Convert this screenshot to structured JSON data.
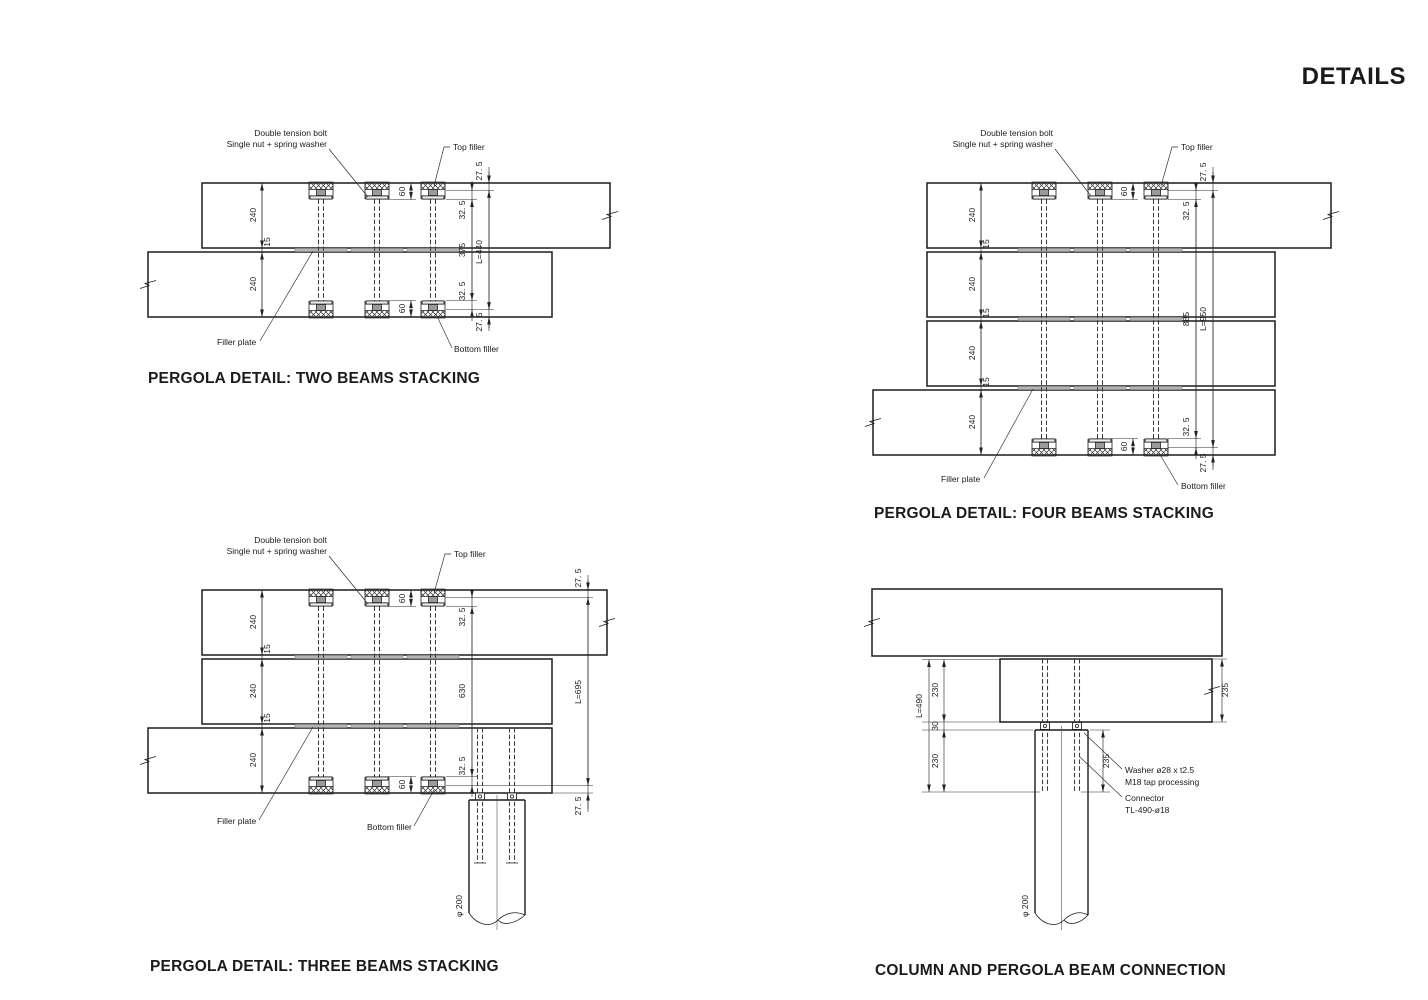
{
  "page_title": "DETAILS",
  "panels": {
    "two": {
      "title": "PERGOLA DETAIL: TWO BEAMS STACKING",
      "labels": {
        "tension_bolt_1": "Double tension bolt",
        "tension_bolt_2": "Single  nut + spring washer",
        "top_filler": "Top filler",
        "filler_plate": "Filler plate",
        "bottom_filler": "Bottom filler"
      },
      "dims": {
        "beams": [
          "240",
          "240"
        ],
        "gaps": [
          "15"
        ],
        "recess_top": "60",
        "recess_bottom": "60",
        "chain_inner": [
          "32. 5",
          "375",
          "32. 5"
        ],
        "chain_outer": [
          "27. 5",
          "L=440",
          "27. 5"
        ]
      }
    },
    "four": {
      "title": "PERGOLA DETAIL: FOUR BEAMS STACKING",
      "labels": {
        "tension_bolt_1": "Double tension bolt",
        "tension_bolt_2": "Single  nut + spring washer",
        "top_filler": "Top filler",
        "filler_plate": "Filler plate",
        "bottom_filler": "Bottom filler"
      },
      "dims": {
        "beams": [
          "240",
          "240",
          "240",
          "240"
        ],
        "gaps": [
          "15",
          "15",
          "15"
        ],
        "recess_top": "60",
        "recess_bottom": "60",
        "chain_inner": [
          "32. 5",
          "885",
          "32. 5"
        ],
        "chain_outer": [
          "27. 5",
          "L=950",
          "27. 5"
        ]
      }
    },
    "three": {
      "title": "PERGOLA DETAIL: THREE BEAMS STACKING",
      "labels": {
        "tension_bolt_1": "Double tension bolt",
        "tension_bolt_2": "Single  nut + spring washer",
        "top_filler": "Top filler",
        "filler_plate": "Filler plate",
        "bottom_filler": "Bottom filler"
      },
      "dims": {
        "beams": [
          "240",
          "240",
          "240"
        ],
        "gaps": [
          "15",
          "15"
        ],
        "recess_top": "60",
        "recess_bottom": "60",
        "chain_inner": [
          "32. 5",
          "630",
          "32. 5"
        ],
        "chain_outer": [
          "27. 5",
          "L=695",
          "27. 5"
        ],
        "column_dia": "φ 200"
      }
    },
    "column": {
      "title": "COLUMN AND PERGOLA BEAM CONNECTION",
      "labels": {
        "washer_1": "Washer ø28 x t2.5",
        "washer_2": "M18 tap processing",
        "connector_1": "Connector",
        "connector_2": "TL-490-ø18"
      },
      "dims": {
        "total": "L=490",
        "chain": [
          "230",
          "30",
          "230"
        ],
        "beam_height": "235",
        "embed": "235",
        "column_dia": "φ 200"
      }
    }
  }
}
